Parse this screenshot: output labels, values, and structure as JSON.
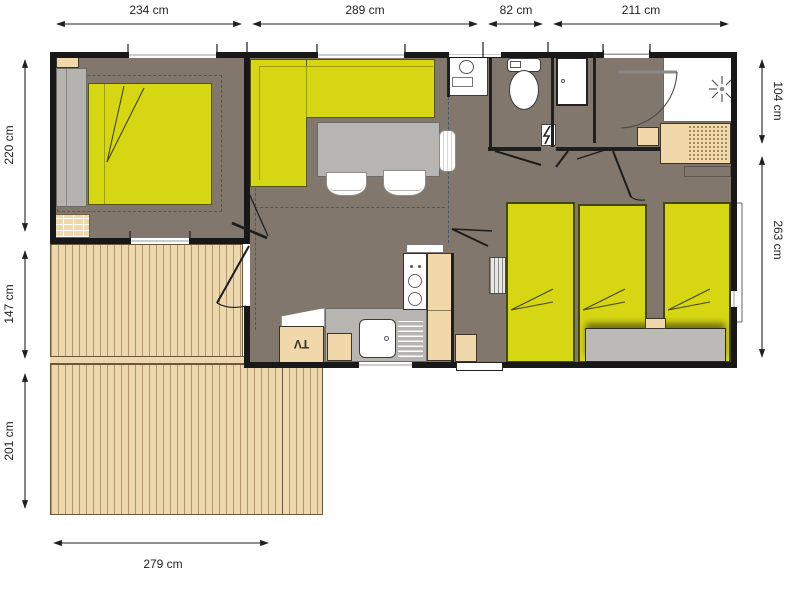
{
  "title": "mobile-home-floor-plan",
  "dimensions": {
    "top": [
      "234 cm",
      "289 cm",
      "82 cm",
      "211 cm"
    ],
    "left": [
      "220 cm",
      "147 cm",
      "201 cm"
    ],
    "right": [
      "104 cm",
      "263 cm"
    ],
    "bottom": [
      "279 cm"
    ]
  },
  "labels": {
    "tv": "TV"
  },
  "icons": {
    "shower": "shower-head-icon",
    "power": "lightning-bolt-icon"
  },
  "colors": {
    "floor": "#81776d",
    "wall": "#181818",
    "yellow": "#d6d712",
    "yellow_border": "#55560e",
    "deck": "#edd8ae",
    "tan": "#f0d8ab",
    "gray_furn": "#b8b6b3",
    "dash": "#4b5570",
    "dim_text": "#231f20"
  }
}
